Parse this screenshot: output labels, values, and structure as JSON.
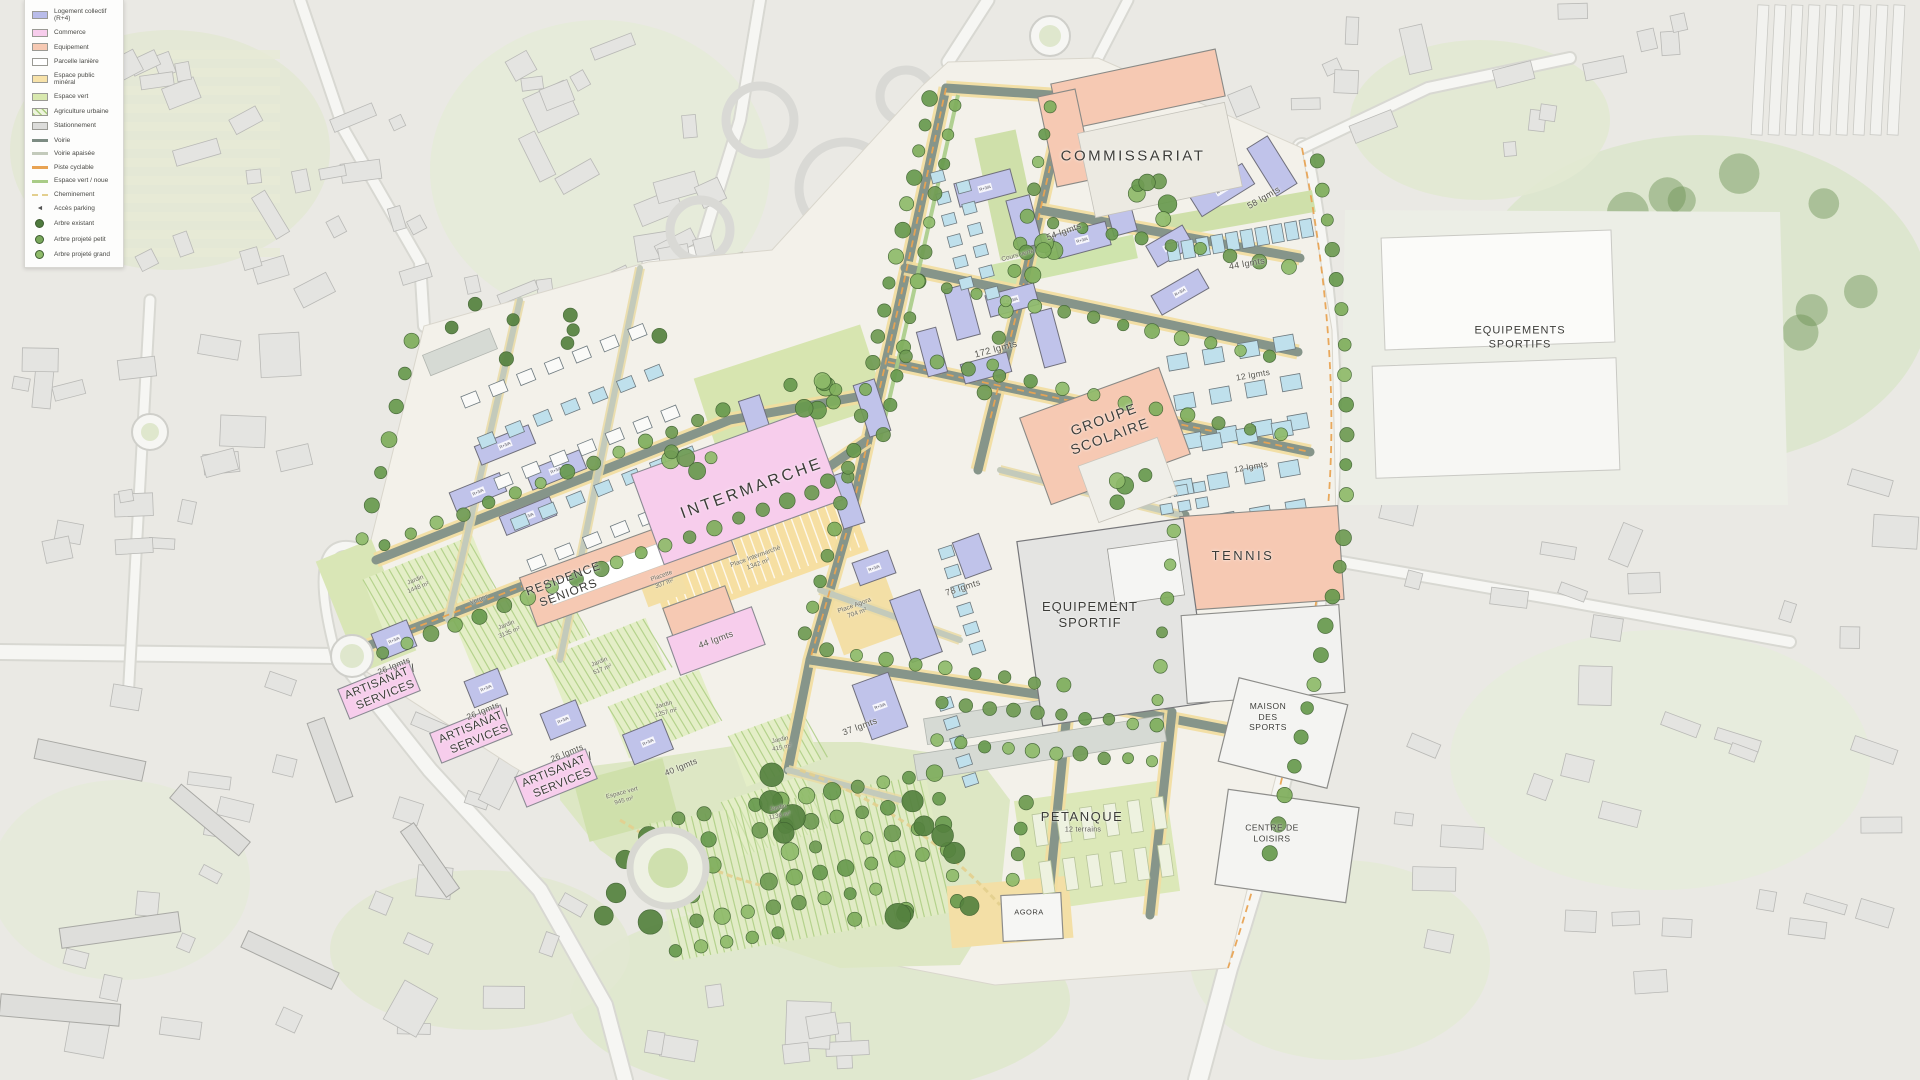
{
  "legend": {
    "items": [
      {
        "label": "Logement collectif (R+4)",
        "swatch": "fill",
        "color": "#b9bce9"
      },
      {
        "label": "Commerce",
        "swatch": "fill",
        "color": "#f7cdec"
      },
      {
        "label": "Equipement",
        "swatch": "fill",
        "color": "#f6c9b3"
      },
      {
        "label": "Parcelle lanière",
        "swatch": "fill",
        "color": "#ffffff"
      },
      {
        "label": "Espace public minéral",
        "swatch": "fill",
        "color": "#f7e2a9"
      },
      {
        "label": "Espace vert",
        "swatch": "fill",
        "color": "#d8e8ae"
      },
      {
        "label": "Agriculture urbaine",
        "swatch": "hatch",
        "color": "#a9cc7e"
      },
      {
        "label": "Stationnement",
        "swatch": "fill",
        "color": "#dcdcda"
      },
      {
        "label": "Voirie",
        "swatch": "line",
        "color": "#7d8c83"
      },
      {
        "label": "Voirie apaisée",
        "swatch": "line",
        "color": "#c3cabb"
      },
      {
        "label": "Piste cyclable",
        "swatch": "line",
        "color": "#e8a353"
      },
      {
        "label": "Espace vert / noue",
        "swatch": "line",
        "color": "#a9cc87"
      },
      {
        "label": "Cheminement",
        "swatch": "dash",
        "color": "#e3cf8e"
      },
      {
        "label": "Accès parking",
        "swatch": "icon",
        "color": "#555555"
      },
      {
        "label": "Arbre existant",
        "swatch": "tree",
        "color": "#4f7a3e"
      },
      {
        "label": "Arbre projeté petit",
        "swatch": "tree",
        "color": "#79a85b"
      },
      {
        "label": "Arbre projeté grand",
        "swatch": "tree",
        "color": "#8fbb6a"
      }
    ]
  },
  "labels": {
    "commissariat": "COMMISSARIAT",
    "equipements_sportifs": "EQUIPEMENTS\nSPORTIFS",
    "groupe_scolaire": "GROUPE\nSCOLAIRE",
    "intermarche": "INTERMARCHE",
    "residence_seniors": "RESIDENCE\nSENIORS",
    "tennis": "TENNIS",
    "equipement_sportif": "EQUIPEMENT\nSPORTIF",
    "maison_des_sports": "MAISON\nDES\nSPORTS",
    "centre_de_loisirs": "CENTRE DE\nLOISIRS",
    "artisanat_services": "ARTISANAT /\nSERVICES",
    "petanque": "PETANQUE",
    "petanque_terrains": "12 terrains",
    "agora": "AGORA",
    "lgmts_54": "54 lgmts",
    "lgmts_58": "58 lgmts",
    "lgmts_44": "44 lgmts",
    "lgmts_172": "172 lgmts",
    "lgmts_12": "12 lgmts",
    "lgmts_78": "78 lgmts",
    "lgmts_37": "37 lgmts",
    "lgmts_26": "26 lgmts",
    "lgmts_40": "40 lgmts",
    "place_intermarche": "Place Intermarché\n1342 m²",
    "place_agora": "Place Agora\n704 m²",
    "placette": "Placette\n307 m²",
    "espace_vert_945": "Espace vert\n945 m²",
    "jardin_1448": "Jardin\n1448 m²",
    "jardin_3135": "Jardin\n3135 m²",
    "jardin_517": "Jardin\n517 m²",
    "jardin_1257": "Jardin\n1257 m²",
    "jardin_415": "Jardin\n415 m²",
    "jardin_1136": "Jardin\n1136 m²",
    "verger": "Verger",
    "cours_verte": "Cours verte"
  },
  "building_tags": {
    "collective": "R+3/A",
    "house": "R+1"
  }
}
